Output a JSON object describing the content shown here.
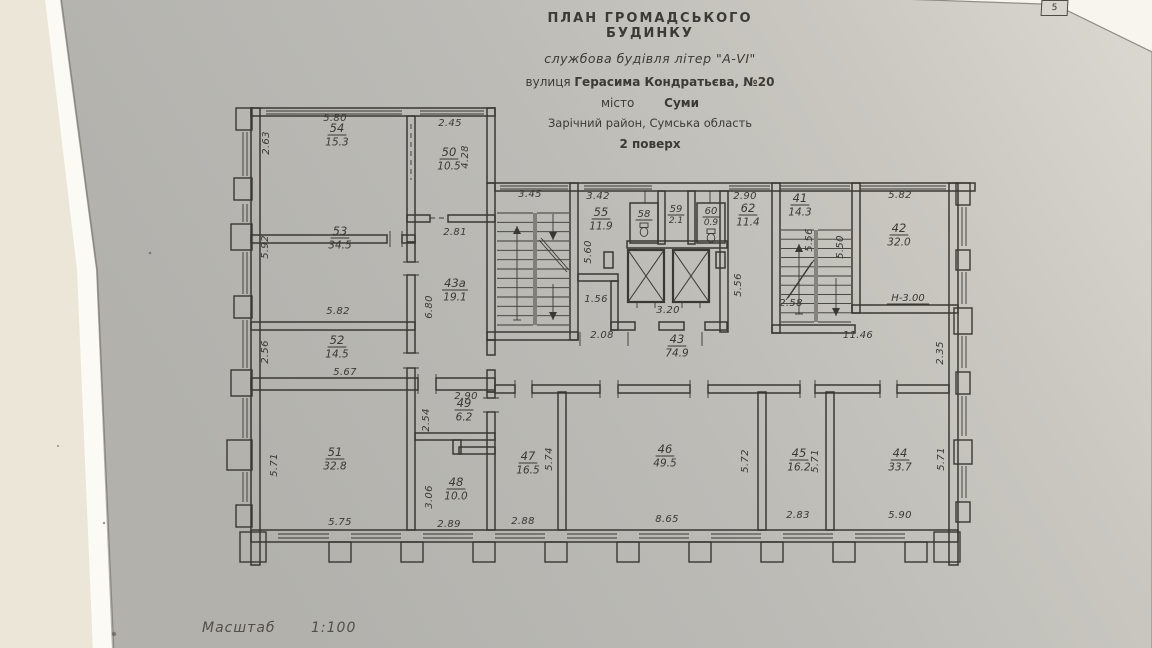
{
  "page_corner_number": "5",
  "title_block": {
    "line1": "ПЛАН  ГРОМАДСЬКОГО  БУДИНКУ",
    "line2": "службова будівля літер \"А-VI\"",
    "street_label": "вулиця",
    "street_value": "Герасима Кондратьєва, №20",
    "city_label": "місто",
    "city_value": "Суми",
    "district": "Зарічний район, Сумська область",
    "floor": "2 поверх"
  },
  "scale_label": "Масштаб",
  "scale_value": "1:100",
  "colors": {
    "ink": "#3a3833",
    "paper": "#bcbbb6",
    "paper_light": "#dbd8d0",
    "background": "#ece7d8"
  },
  "plan": {
    "rooms": [
      {
        "number": "54",
        "area": "15.3",
        "x": 337,
        "y": 132
      },
      {
        "number": "50",
        "area": "10.5",
        "x": 449,
        "y": 156
      },
      {
        "number": "53",
        "area": "34.5",
        "x": 340,
        "y": 235
      },
      {
        "number": "43а",
        "area": "19.1",
        "x": 455,
        "y": 287
      },
      {
        "number": "52",
        "area": "14.5",
        "x": 337,
        "y": 344
      },
      {
        "number": "49",
        "area": "6.2",
        "x": 464,
        "y": 407
      },
      {
        "number": "51",
        "area": "32.8",
        "x": 335,
        "y": 456
      },
      {
        "number": "48",
        "area": "10.0",
        "x": 456,
        "y": 486
      },
      {
        "number": "55",
        "area": "11.9",
        "x": 601,
        "y": 216
      },
      {
        "number": "58",
        "area": "",
        "x": 644,
        "y": 217,
        "small": true,
        "icon": "toilet"
      },
      {
        "number": "59",
        "area": "2.1",
        "x": 676,
        "y": 212,
        "small": true
      },
      {
        "number": "60",
        "area": "0.9",
        "x": 711,
        "y": 214,
        "small": true,
        "icon": "toilet"
      },
      {
        "number": "62",
        "area": "11.4",
        "x": 748,
        "y": 212
      },
      {
        "number": "41",
        "area": "14.3",
        "x": 800,
        "y": 202
      },
      {
        "number": "42",
        "area": "32.0",
        "x": 899,
        "y": 232
      },
      {
        "number": "43",
        "area": "74.9",
        "x": 677,
        "y": 343
      },
      {
        "number": "47",
        "area": "16.5",
        "x": 528,
        "y": 460
      },
      {
        "number": "46",
        "area": "49.5",
        "x": 665,
        "y": 453
      },
      {
        "number": "45",
        "area": "16.2",
        "x": 799,
        "y": 457
      },
      {
        "number": "44",
        "area": "33.7",
        "x": 900,
        "y": 457
      }
    ],
    "dimensions": [
      {
        "text": "5.80",
        "x": 335,
        "y": 121,
        "rot": 0
      },
      {
        "text": "2.63",
        "x": 269,
        "y": 143,
        "rot": 90
      },
      {
        "text": "2.45",
        "x": 450,
        "y": 126,
        "rot": 0
      },
      {
        "text": "4.28",
        "x": 468,
        "y": 157,
        "rot": 90
      },
      {
        "text": "5.92",
        "x": 268,
        "y": 247,
        "rot": 90
      },
      {
        "text": "5.82",
        "x": 338,
        "y": 314,
        "rot": 0
      },
      {
        "text": "2.81",
        "x": 455,
        "y": 235,
        "rot": 0
      },
      {
        "text": "6.80",
        "x": 432,
        "y": 307,
        "rot": 90
      },
      {
        "text": "2.56",
        "x": 268,
        "y": 352,
        "rot": 90
      },
      {
        "text": "5.67",
        "x": 345,
        "y": 375,
        "rot": 0
      },
      {
        "text": "2.90",
        "x": 466,
        "y": 399,
        "rot": 0
      },
      {
        "text": "2.54",
        "x": 429,
        "y": 420,
        "rot": 90
      },
      {
        "text": "3.06",
        "x": 432,
        "y": 497,
        "rot": 90
      },
      {
        "text": "2.89",
        "x": 449,
        "y": 527,
        "rot": 0
      },
      {
        "text": "5.71",
        "x": 277,
        "y": 465,
        "rot": 90
      },
      {
        "text": "5.75",
        "x": 340,
        "y": 525,
        "rot": 0
      },
      {
        "text": "3.45",
        "x": 530,
        "y": 197,
        "rot": 0
      },
      {
        "text": "3.42",
        "x": 598,
        "y": 199,
        "rot": 0
      },
      {
        "text": "5.60",
        "x": 591,
        "y": 252,
        "rot": 90
      },
      {
        "text": "1.56",
        "x": 596,
        "y": 302,
        "rot": 0
      },
      {
        "text": "2.90",
        "x": 745,
        "y": 199,
        "rot": 0
      },
      {
        "text": "5.56",
        "x": 741,
        "y": 285,
        "rot": 90
      },
      {
        "text": "3.20",
        "x": 668,
        "y": 313,
        "rot": 0
      },
      {
        "text": "2.08",
        "x": 602,
        "y": 338,
        "rot": 0
      },
      {
        "text": "2.58",
        "x": 791,
        "y": 306,
        "rot": 0
      },
      {
        "text": "5.56",
        "x": 812,
        "y": 240,
        "rot": 90
      },
      {
        "text": "5.50",
        "x": 843,
        "y": 247,
        "rot": 90
      },
      {
        "text": "5.82",
        "x": 900,
        "y": 198,
        "rot": 0
      },
      {
        "text": "11.46",
        "x": 858,
        "y": 338,
        "rot": 0
      },
      {
        "text": "2.35",
        "x": 943,
        "y": 353,
        "rot": 90
      },
      {
        "text": "5.74",
        "x": 552,
        "y": 459,
        "rot": 90
      },
      {
        "text": "2.88",
        "x": 523,
        "y": 524,
        "rot": 0
      },
      {
        "text": "5.72",
        "x": 748,
        "y": 461,
        "rot": 90
      },
      {
        "text": "8.65",
        "x": 667,
        "y": 522,
        "rot": 0
      },
      {
        "text": "5.71",
        "x": 818,
        "y": 461,
        "rot": 90
      },
      {
        "text": "2.83",
        "x": 798,
        "y": 518,
        "rot": 0
      },
      {
        "text": "5.71",
        "x": 944,
        "y": 459,
        "rot": 90
      },
      {
        "text": "5.90",
        "x": 900,
        "y": 518,
        "rot": 0
      }
    ],
    "height_mark": {
      "text": "Н-3.00",
      "x": 908,
      "y": 301
    }
  }
}
